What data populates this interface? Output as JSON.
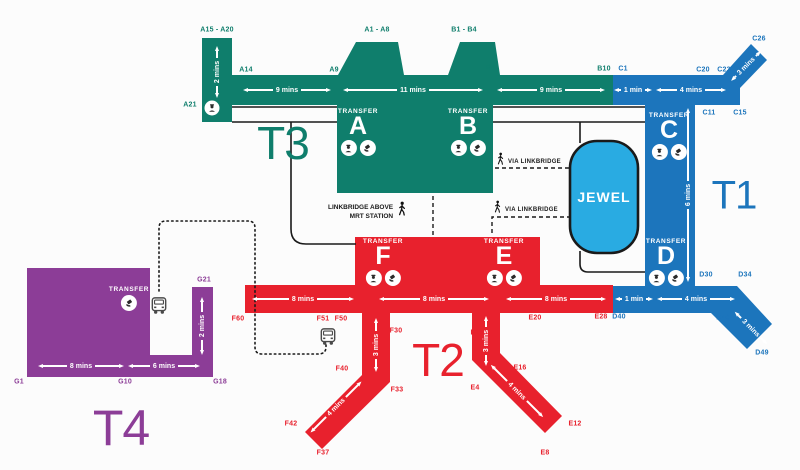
{
  "colors": {
    "t1": "#1C75BC",
    "t2": "#E8212D",
    "t3": "#0F7E6C",
    "t4": "#8C3D97",
    "jewel": "#29ABE2",
    "outline": "#1A1A1A",
    "arrow": "#FFFFFF",
    "bus": "#4A4A4A"
  },
  "terminals": [
    {
      "key": "t3",
      "label": "T3",
      "x": 283,
      "y": 143,
      "size": 46
    },
    {
      "key": "t1",
      "label": "T1",
      "x": 734,
      "y": 196,
      "size": 40
    },
    {
      "key": "t2",
      "label": "T2",
      "x": 438,
      "y": 360,
      "size": 46
    },
    {
      "key": "t4",
      "label": "T4",
      "x": 121,
      "y": 428,
      "size": 50
    }
  ],
  "jewel": {
    "label": "JEWEL"
  },
  "transfer_label": "TRANSFER",
  "transfer_points": [
    {
      "letter": "A",
      "x": 358,
      "y": 108,
      "icons": [
        "immigration-officer",
        "transfer-counter"
      ]
    },
    {
      "letter": "B",
      "x": 468,
      "y": 108,
      "icons": [
        "immigration-officer",
        "transfer-counter"
      ]
    },
    {
      "letter": "C",
      "x": 669,
      "y": 112,
      "icons": [
        "immigration-officer",
        "transfer-counter"
      ]
    },
    {
      "letter": "D",
      "x": 666,
      "y": 238,
      "icons": [
        "immigration-officer",
        "transfer-counter"
      ]
    },
    {
      "letter": "F",
      "x": 383,
      "y": 238,
      "icons": [
        "immigration-officer",
        "transfer-counter"
      ]
    },
    {
      "letter": "E",
      "x": 504,
      "y": 238,
      "icons": [
        "immigration-officer",
        "transfer-counter"
      ]
    },
    {
      "letter": "",
      "x": 129,
      "y": 286,
      "icons": [
        "transfer-counter"
      ]
    }
  ],
  "gates": [
    {
      "label": "A15 - A20",
      "t": "t3",
      "x": 217,
      "y": 30
    },
    {
      "label": "A14",
      "t": "t3",
      "x": 246,
      "y": 70
    },
    {
      "label": "A21",
      "t": "t3",
      "x": 190,
      "y": 105
    },
    {
      "label": "A1 - A8",
      "t": "t3",
      "x": 377,
      "y": 30
    },
    {
      "label": "A9",
      "t": "t3",
      "x": 334,
      "y": 70
    },
    {
      "label": "B1 - B4",
      "t": "t3",
      "x": 464,
      "y": 30
    },
    {
      "label": "B5",
      "t": "t3",
      "x": 491,
      "y": 68
    },
    {
      "label": "B10",
      "t": "t3",
      "x": 604,
      "y": 69
    },
    {
      "label": "C1",
      "t": "t1",
      "x": 623,
      "y": 69
    },
    {
      "label": "C20",
      "t": "t1",
      "x": 703,
      "y": 70
    },
    {
      "label": "C23",
      "t": "t1",
      "x": 724,
      "y": 70
    },
    {
      "label": "C26",
      "t": "t1",
      "x": 759,
      "y": 39
    },
    {
      "label": "C11",
      "t": "t1",
      "x": 709,
      "y": 113
    },
    {
      "label": "C15",
      "t": "t1",
      "x": 740,
      "y": 113
    },
    {
      "label": "D30",
      "t": "t1",
      "x": 706,
      "y": 275
    },
    {
      "label": "D34",
      "t": "t1",
      "x": 745,
      "y": 275
    },
    {
      "label": "D40",
      "t": "t1",
      "x": 619,
      "y": 317
    },
    {
      "label": "D46",
      "t": "t1",
      "x": 723,
      "y": 318
    },
    {
      "label": "D49",
      "t": "t1",
      "x": 762,
      "y": 353
    },
    {
      "label": "F60",
      "t": "t2",
      "x": 238,
      "y": 319
    },
    {
      "label": "F51",
      "t": "t2",
      "x": 323,
      "y": 319
    },
    {
      "label": "F50",
      "t": "t2",
      "x": 341,
      "y": 319
    },
    {
      "label": "F30",
      "t": "t2",
      "x": 396,
      "y": 331
    },
    {
      "label": "F40",
      "t": "t2",
      "x": 342,
      "y": 369
    },
    {
      "label": "F33",
      "t": "t2",
      "x": 397,
      "y": 390
    },
    {
      "label": "F42",
      "t": "t2",
      "x": 291,
      "y": 424
    },
    {
      "label": "F37",
      "t": "t2",
      "x": 323,
      "y": 453
    },
    {
      "label": "E1",
      "t": "t2",
      "x": 475,
      "y": 333
    },
    {
      "label": "E4",
      "t": "t2",
      "x": 475,
      "y": 388
    },
    {
      "label": "E16",
      "t": "t2",
      "x": 520,
      "y": 368
    },
    {
      "label": "E20",
      "t": "t2",
      "x": 535,
      "y": 318
    },
    {
      "label": "E28",
      "t": "t2",
      "x": 601,
      "y": 317
    },
    {
      "label": "E12",
      "t": "t2",
      "x": 575,
      "y": 424
    },
    {
      "label": "E8",
      "t": "t2",
      "x": 545,
      "y": 453
    },
    {
      "label": "G21",
      "t": "t4",
      "x": 204,
      "y": 280
    },
    {
      "label": "G1",
      "t": "t4",
      "x": 19,
      "y": 382
    },
    {
      "label": "G10",
      "t": "t4",
      "x": 125,
      "y": 382
    },
    {
      "label": "G18",
      "t": "t4",
      "x": 220,
      "y": 382
    }
  ],
  "walk_times": [
    {
      "label": "2 mins",
      "x": 217,
      "y": 72,
      "len": 52,
      "rot": -90
    },
    {
      "label": "9 mins",
      "x": 287,
      "y": 90,
      "len": 88,
      "rot": 0
    },
    {
      "label": "11 mins",
      "x": 413,
      "y": 90,
      "len": 140,
      "rot": 0
    },
    {
      "label": "9 mins",
      "x": 551,
      "y": 90,
      "len": 108,
      "rot": 0
    },
    {
      "label": "1 min",
      "x": 633,
      "y": 90,
      "len": 38,
      "rot": 0
    },
    {
      "label": "4 mins",
      "x": 691,
      "y": 90,
      "len": 70,
      "rot": 0
    },
    {
      "label": "3 mins",
      "x": 746,
      "y": 66,
      "len": 42,
      "rot": -45
    },
    {
      "label": "6 mins",
      "x": 688,
      "y": 195,
      "len": 174,
      "rot": -90
    },
    {
      "label": "1 min",
      "x": 634,
      "y": 299,
      "len": 38,
      "rot": 0
    },
    {
      "label": "4 mins",
      "x": 696,
      "y": 299,
      "len": 78,
      "rot": 0
    },
    {
      "label": "3 mins",
      "x": 751,
      "y": 328,
      "len": 46,
      "rot": 45
    },
    {
      "label": "8 mins",
      "x": 303,
      "y": 299,
      "len": 102,
      "rot": 0
    },
    {
      "label": "8 mins",
      "x": 434,
      "y": 299,
      "len": 110,
      "rot": 0
    },
    {
      "label": "8 mins",
      "x": 556,
      "y": 299,
      "len": 100,
      "rot": 0
    },
    {
      "label": "3 mins",
      "x": 376,
      "y": 345,
      "len": 54,
      "rot": -90
    },
    {
      "label": "3 mins",
      "x": 486,
      "y": 341,
      "len": 50,
      "rot": -90
    },
    {
      "label": "4 mins",
      "x": 336,
      "y": 407,
      "len": 72,
      "rot": -45
    },
    {
      "label": "4 mins",
      "x": 517,
      "y": 391,
      "len": 74,
      "rot": 45
    },
    {
      "label": "8 mins",
      "x": 81,
      "y": 366,
      "len": 86,
      "rot": 0
    },
    {
      "label": "6 mins",
      "x": 164,
      "y": 366,
      "len": 72,
      "rot": 0
    },
    {
      "label": "2 mins",
      "x": 202,
      "y": 326,
      "len": 58,
      "rot": -90
    }
  ],
  "notes": {
    "via_linkbridge_top": "VIA LINKBRIDGE",
    "via_linkbridge_mid": "VIA LINKBRIDGE",
    "mrt_line1": "LINKBRIDGE ABOVE",
    "mrt_line2": "MRT STATION"
  }
}
